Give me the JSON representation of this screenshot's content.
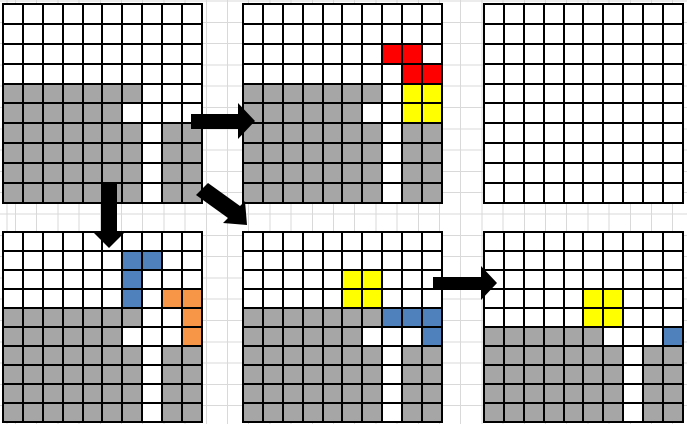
{
  "colors": {
    "w": "#ffffff",
    "g": "#a6a6a6",
    "r": "#ff0000",
    "y": "#ffff00",
    "b": "#4f81bd",
    "o": "#f79646",
    "grid_line": "#000000",
    "paper_line": "#d9d9d9",
    "arrow": "#000000"
  },
  "legend": {
    "w": "empty",
    "g": "gray-stack",
    "r": "red-s-piece",
    "y": "yellow-o-piece",
    "b": "blue-j-piece",
    "o": "orange-l-piece"
  },
  "boards": [
    {
      "id": "board-top-left",
      "rows": [
        "wwwwwwwwww",
        "wwwwwwwwww",
        "wwwwwwwwww",
        "wwwwwwwwww",
        "gggggggwww",
        "ggggggwwww",
        "gggggggwgg",
        "gggggggwgg",
        "gggggggwgg",
        "gggggggwgg"
      ]
    },
    {
      "id": "board-top-middle",
      "rows": [
        "wwwwwwwwww",
        "wwwwwwwwww",
        "wwwwwwwrrw",
        "wwwwwwwwrr",
        "gggggggwyy",
        "ggggggwwyy",
        "gggggggwgg",
        "gggggggwgg",
        "gggggggwgg",
        "gggggggwgg"
      ]
    },
    {
      "id": "board-top-right",
      "rows": [
        "wwwwwwwwww",
        "wwwwwwwwww",
        "wwwwwwwwww",
        "wwwwwwwwww",
        "wwwwwwwwww",
        "wwwwwwwwww",
        "wwwwwwwwww",
        "wwwwwwwwww",
        "wwwwwwwwww",
        "wwwwwwwwww"
      ]
    },
    {
      "id": "board-bottom-left",
      "rows": [
        "wwwwwwwwww",
        "wwwwwwbbww",
        "wwwwwwbwww",
        "wwwwwwbwoo",
        "gggggggwwo",
        "ggggggwwwo",
        "gggggggwgg",
        "gggggggwgg",
        "gggggggwgg",
        "gggggggwgg"
      ]
    },
    {
      "id": "board-bottom-middle",
      "rows": [
        "wwwwwwwwww",
        "wwwwwwwwww",
        "wwwwwyywww",
        "wwwwwyywww",
        "gggggggbbb",
        "ggggggwwwb",
        "gggggggwgg",
        "gggggggwgg",
        "gggggggwgg",
        "gggggggwgg"
      ]
    },
    {
      "id": "board-bottom-right",
      "rows": [
        "wwwwwwwwww",
        "wwwwwwwwww",
        "wwwwwwwwww",
        "wwwwwyywww",
        "wwwwwyywww",
        "ggggggwwwb",
        "gggggggwgg",
        "gggggggwgg",
        "gggggggwgg",
        "gggggggwgg"
      ]
    }
  ],
  "arrows": [
    {
      "name": "arrow-top-left-to-top-middle",
      "from": "board-top-left",
      "to": "board-top-middle",
      "direction": "right",
      "points": "191,114 238,114 238,103 255,121 238,139 238,129 191,129"
    },
    {
      "name": "arrow-top-left-to-bottom-left",
      "from": "board-top-left",
      "to": "board-bottom-left",
      "direction": "down",
      "points": "101,184 117,184 117,231 126,231 109,248 92,231 101,231"
    },
    {
      "name": "arrow-top-left-to-bottom-middle",
      "from": "board-top-left",
      "to": "board-bottom-middle",
      "direction": "down-right",
      "points": "208,183 240,206 245,201 247,225 223,223 228,218 196,195"
    },
    {
      "name": "arrow-bottom-middle-to-bottom-right",
      "from": "board-bottom-middle",
      "to": "board-bottom-right",
      "direction": "right",
      "points": "433,277 481,277 481,266 497,283 481,300 481,290 433,290"
    }
  ]
}
